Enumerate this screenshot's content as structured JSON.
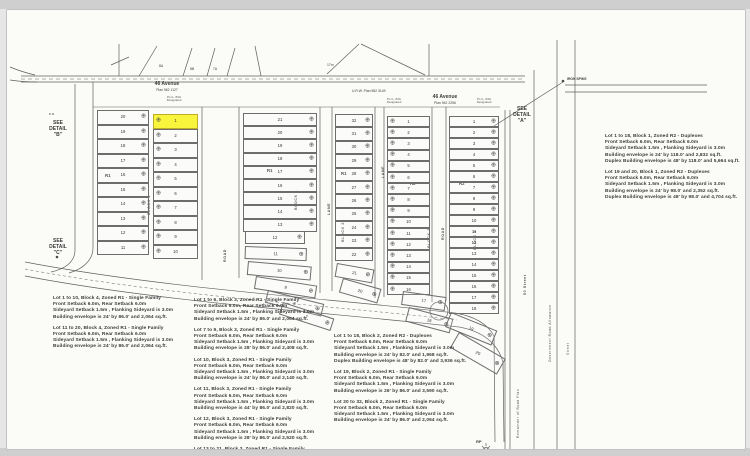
{
  "page": {
    "background": "#e6e6e6",
    "sheet_color": "#fbfbf8",
    "line_color": "#5f5f5f",
    "highlight_color": "#f9f53c"
  },
  "streets": {
    "avenue46_left": {
      "name": "46 Avenue",
      "plan": "Plan 962 1127"
    },
    "avenue46_right": {
      "name": "46 Avenue",
      "plan": "Plan 942 2256"
    },
    "urw_label": "U.R.W. Plan 982 3149",
    "dim_17m": "17m",
    "street50": "50 Street",
    "gov_road_allowance": "Government Road Allowance",
    "street_short": "Street",
    "remainder_road": "Remainder of Road Plan",
    "lane1": "LANE",
    "lane2": "LANE",
    "road1": "ROAD",
    "road2": "ROAD"
  },
  "markers": {
    "iron_spike": "IRON SPIKE",
    "rp": "RP",
    "pul": "P.U.L. 84G Designated",
    "bm": "B.M."
  },
  "details": {
    "a": [
      "SEE",
      "DETAIL",
      "\"A\""
    ],
    "b": [
      "SEE",
      "DETAIL",
      "\"B\""
    ],
    "c": [
      "SEE",
      "DETAIL",
      "\"C\""
    ]
  },
  "top_parcels": [
    "8A",
    "8B",
    "7A"
  ],
  "plat": {
    "highlight_note": "Lot 1, Block 4 highlighted",
    "columns": [
      {
        "name": "block4-west",
        "zone_label": "R1",
        "block_label": "BLOCK 4",
        "lots": [
          "20",
          "19",
          "18",
          "17",
          "16",
          "15",
          "14",
          "13",
          "12",
          "11"
        ]
      },
      {
        "name": "block4-east",
        "highlight_lot": "1",
        "lots": [
          "1",
          "2",
          "3",
          "4",
          "5",
          "6",
          "7",
          "8",
          "9",
          "10"
        ]
      },
      {
        "name": "block3",
        "zone_label": "R1",
        "block_label": "BLOCK 3",
        "lots": [
          "21",
          "20",
          "19",
          "18",
          "17",
          "16",
          "15",
          "14",
          "13"
        ]
      },
      {
        "name": "block2-r1",
        "zone_label": "R1",
        "block_label": "BLOCK 2",
        "lots": [
          "32",
          "31",
          "30",
          "29",
          "28",
          "27",
          "26",
          "25",
          "24",
          "23",
          "22"
        ]
      },
      {
        "name": "block2-r2",
        "zone_label": "R2",
        "block_label": "BLOCK 2",
        "lots": [
          "1",
          "2",
          "3",
          "4",
          "5",
          "6",
          "7",
          "8",
          "9",
          "10",
          "11",
          "12",
          "13",
          "14",
          "15",
          "16"
        ]
      },
      {
        "name": "block1-r2",
        "zone_label": "R2",
        "block_label": "BLOCK 1",
        "lots": [
          "1",
          "2",
          "3",
          "4",
          "5",
          "6",
          "7",
          "8",
          "9",
          "10",
          "11",
          "12",
          "13",
          "14",
          "15",
          "16",
          "17",
          "18"
        ]
      }
    ],
    "irregular_lots": [
      "12",
      "11",
      "10",
      "9",
      "8",
      "7",
      "21",
      "20",
      "17",
      "18",
      "19",
      "20"
    ]
  },
  "notes": {
    "groups": [
      {
        "id": "block4-notes",
        "paragraphs": [
          {
            "lines": [
              "Lot 1 to 10, Block 4, Zoned R1 - Single Family",
              "Front Setback 6.0m, Rear Setback 6.0m",
              "Sideyard Setback 1.5m , Flanking Sideyard is 3.0m",
              "Building envelope is 24' by 86.0' and 2,064 sq.ft."
            ]
          },
          {
            "lines": [
              "Lot 11 to 20, Block 4, Zoned R1 - Single Family",
              "Front Setback 6.0m, Rear Setback 6.0m",
              "Sideyard Setback 1.5m , Flanking Sideyard is 3.0m",
              "Building envelope is 24' by 86.0' and 2,064 sq.ft."
            ]
          }
        ]
      },
      {
        "id": "block3-notes",
        "paragraphs": [
          {
            "lines": [
              "Lot 1 to 6, Block 3, Zoned R1 - Single Family",
              "Front Setback 6.0m, Rear Setback 6.0m",
              "Sideyard Setback 1.5m , Flanking Sideyard is 3.0m",
              "Building envelope is 24' by 86.0' and 2,064 sq.ft."
            ]
          },
          {
            "lines": [
              "Lot 7 to 9, Block 3, Zoned R1 - Single Family",
              "Front Setback 6.0m, Rear Setback 6.0m",
              "Sideyard Setback 1.5m , Flanking Sideyard is 3.0m",
              "Building envelope is 28' by 86.0' and 2,408 sq.ft."
            ]
          },
          {
            "lines": [
              "Lot 10, Block 3, Zoned R1 - Single Family",
              "Front Setback 6.0m, Rear Setback 6.0m",
              "Sideyard Setback 1.5m , Flanking Sideyard is 3.0m",
              "Building envelope is 24' by 86.0' and 2,140 sq.ft."
            ]
          },
          {
            "lines": [
              "Lot 11, Block 3, Zoned R1 - Single Family",
              "Front Setback 6.0m, Rear Setback 6.0m",
              "Sideyard Setback 1.5m , Flanking Sideyard is 3.0m",
              "Building envelope is 44' by 86.0' and 2,820 sq.ft."
            ]
          },
          {
            "lines": [
              "Lot 12, Block 3, Zoned R1 - Single Family",
              "Front Setback 6.0m, Rear Setback 6.0m",
              "Sideyard Setback 1.5m , Flanking Sideyard is 3.0m",
              "Building envelope is 28' by 86.0' and 2,520 sq.ft."
            ]
          },
          {
            "lines": [
              "Lot 13 to 21, Block 3, Zoned R1 - Single Family",
              "Front Setback 6.0m, Rear Setback 6.0m",
              "Sideyard Setback 1.5m , Flanking Sideyard is 3.0m"
            ]
          }
        ]
      },
      {
        "id": "block2-notes",
        "paragraphs": [
          {
            "lines": [
              "Lot 1 to 18, Block 2, Zoned R2 - Duplexes",
              "Front Setback 6.0m, Rear Setback 6.0m",
              "Sideyard Setback 1.5m , Flanking Sideyard is 3.0m",
              "Building envelope is 24' by 82.0' and 1,968 sq.ft.",
              "Duplex Building envelope is 48' by 82.0' and 3,936 sq.ft."
            ]
          },
          {
            "lines": [
              "Lot 19, Block 2, Zoned R1 - Single Family",
              "Front Setback 6.0m, Rear Setback 6.0m",
              "Sideyard Setback 1.5m , Flanking Sideyard is 3.0m",
              "Building envelope is 26' by 86.0' and 3,590 sq.ft."
            ]
          },
          {
            "lines": [
              "Lot 20 to 32, Block 2, Zoned R1 - Single Family",
              "Front Setback 6.0m, Rear Setback 6.0m",
              "Sideyard Setback 1.5m , Flanking Sideyard is 3.0m",
              "Building envelope is 24' by 86.0' and 2,064 sq.ft."
            ]
          }
        ]
      },
      {
        "id": "block1-notes",
        "paragraphs": [
          {
            "lines": [
              "Lot 1 to 18, Block 1, Zoned R2 - Duplexes",
              "Front Setback 6.0m, Rear Setback 6.0m",
              "Sideyard Setback 1.5m , Flanking Sideyard is 3.0m",
              "Building envelope is 24' by 118.0' and 2,832 sq.ft.",
              "Duplex Building envelope is 48' by 118.0' and 5,664 sq.ft."
            ]
          },
          {
            "lines": [
              "Lot 19 and 20, Block 1, Zoned R2 - Duplexes",
              "Front Setback 6.0m, Rear Setback 6.0m",
              "Sideyard Setback 1.5m , Flanking Sideyard is 3.0m",
              "Building envelope is 24' by 98.0' and 2,352 sq.ft.",
              "Duplex Building envelope is 48' by 98.0' and 4,704 sq.ft."
            ]
          }
        ]
      }
    ]
  }
}
